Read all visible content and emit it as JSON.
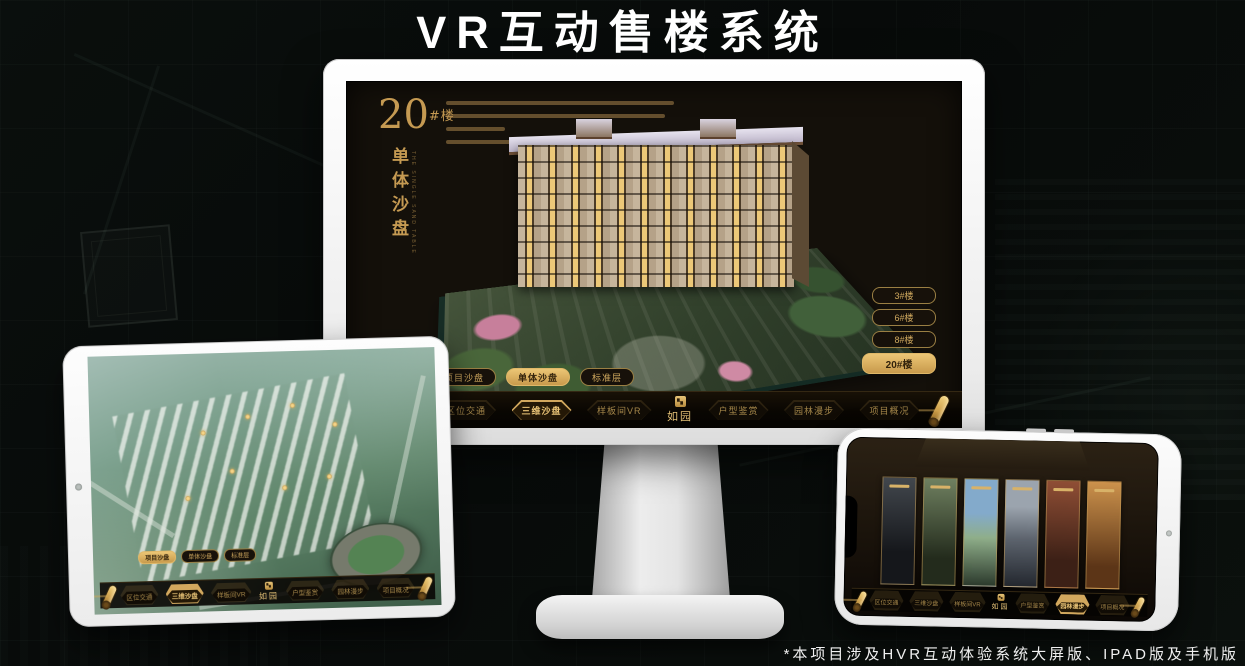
{
  "title": "VR互动售楼系统",
  "footnote": "*本项目涉及HVR互动体验系统大屏版、IPAD版及手机版",
  "colors": {
    "gold": "#caa255",
    "gold_bright": "#ecc675",
    "active_pill_bg": "#e0b560",
    "active_pill_text": "#33230c",
    "screen_bg": "#14100a",
    "nav_bg": "#090602",
    "title_text": "#ffffff"
  },
  "app": {
    "logo": "如园",
    "tabs": [
      "项目沙盘",
      "单体沙盘",
      "标准层"
    ],
    "nav": [
      "区位交通",
      "三维沙盘",
      "样板间VR",
      "户型鉴赏",
      "园林漫步",
      "项目概况"
    ]
  },
  "monitor": {
    "heading": "20",
    "heading_suffix": "#楼",
    "subheading": "单体沙盘",
    "subheading_en": "THE SINGLE SAND TABLE",
    "floor_buttons": [
      "3#楼",
      "6#楼",
      "8#楼",
      "20#楼"
    ],
    "active_floor": "20#楼",
    "active_tab": "单体沙盘",
    "active_nav": "三维沙盘"
  },
  "tablet": {
    "active_tab": "项目沙盘",
    "active_nav": "三维沙盘"
  },
  "phone": {
    "active_nav": "园林漫步",
    "card_count": 6
  }
}
